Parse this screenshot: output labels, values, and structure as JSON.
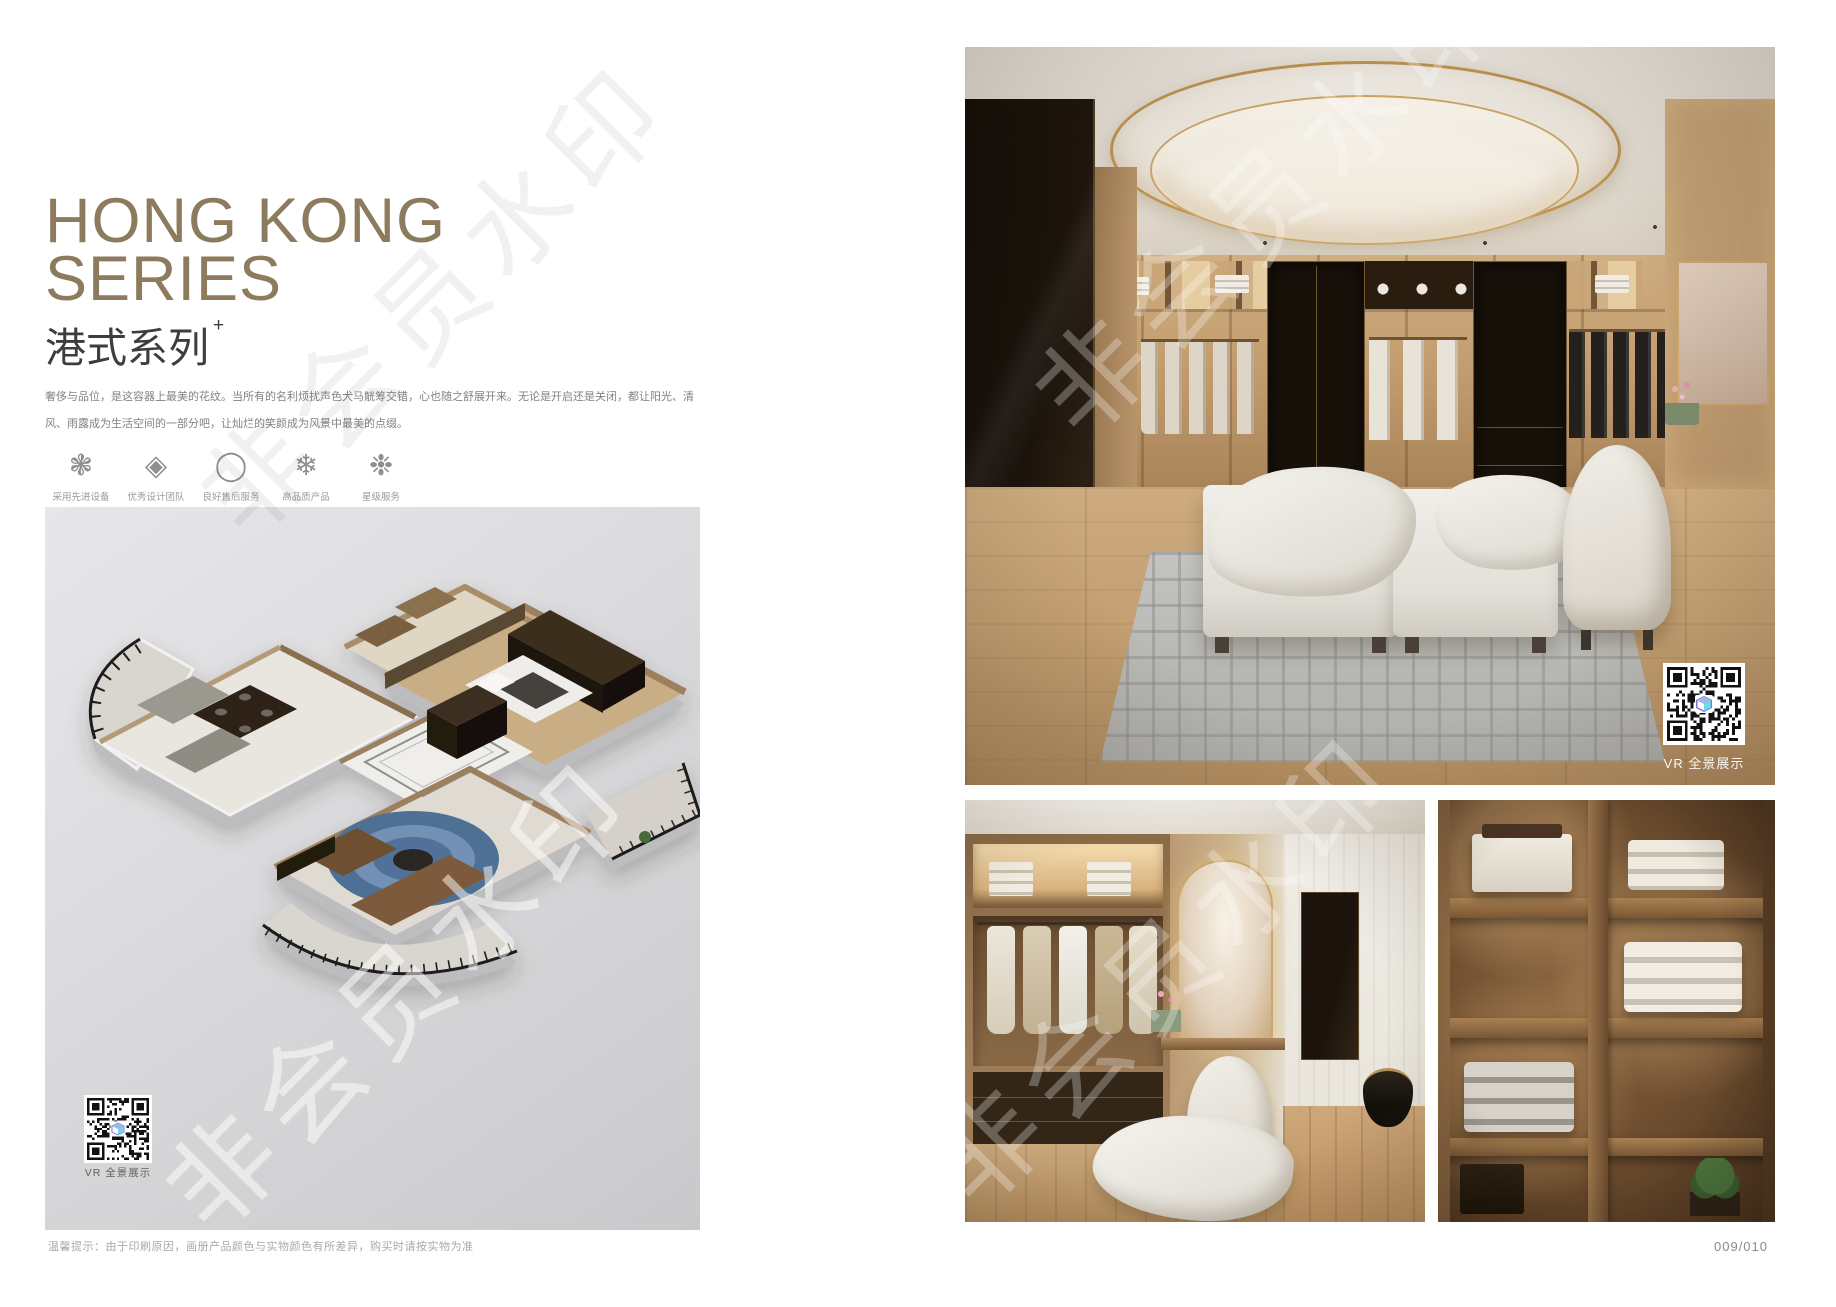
{
  "page": {
    "watermark_text": "非会员水印",
    "page_number": "009/010",
    "disclaimer": "温馨提示：由于印刷原因，画册产品颜色与实物颜色有所差异，购买时请按实物为准",
    "vr_label": "VR 全景展示"
  },
  "header": {
    "title_line1": "HONG KONG",
    "title_line2": "SERIES",
    "subtitle_cn": "港式系列",
    "subtitle_sup": "+",
    "description": "奢侈与品位，是这容器上最美的花纹。当所有的名利烦扰声色犬马觥筹交错，心也随之舒展开来。无论是开启还是关闭，都让阳光、清风、雨露成为生活空间的一部分吧，让灿烂的笑颜成为风景中最美的点缀。"
  },
  "features": [
    {
      "icon": "clover-ornament-icon",
      "glyph": "❃",
      "label": "采用先进设备"
    },
    {
      "icon": "diamond-weave-icon",
      "glyph": "◈",
      "label": "优秀设计团队"
    },
    {
      "icon": "ring-icon",
      "glyph": "◯",
      "label": "良好售后服务"
    },
    {
      "icon": "snowflake-icon",
      "glyph": "❄",
      "label": "高品质产品"
    },
    {
      "icon": "ornate-snowflake-icon",
      "glyph": "❉",
      "label": "星级服务"
    }
  ],
  "colors": {
    "title_gold": "#8d7b5d",
    "text_dark": "#3d3d3d",
    "body_gray": "#828282",
    "label_gray": "#9b9b9b",
    "footer_gray": "#a9a9a9",
    "panel_gray": "#d8d8da",
    "wood_accent": "#b9946a",
    "qr_dark": "#111111"
  }
}
